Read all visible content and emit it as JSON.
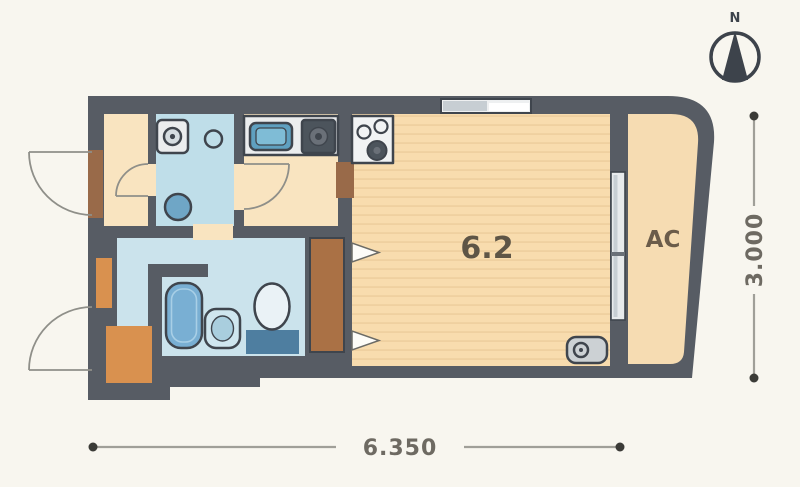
{
  "floor_plan": {
    "main_room_label": "6.2",
    "balcony_label": "AC",
    "compass_label": "N",
    "dimension_width_label": "6.350",
    "dimension_height_label": "3.000",
    "colors": {
      "background": "#f8f6ef",
      "wall": "#575c64",
      "floor_hall": "#f9e4c0",
      "floor_main": "#f8dcae",
      "floor_main_stripe": "#efd0a0",
      "floor_balcony": "#f6dcb2",
      "wet_room": "#bfdee9",
      "bathroom": "#cbe3ec",
      "fixture_blue": "#79afd3",
      "accent_orange": "#d9914f",
      "door_brown": "#996a49",
      "closet_brown": "#aa7145",
      "outline_dark": "#3f454d",
      "glass_gray": "#c7ced3",
      "dim_line": "#a09f98",
      "dim_text": "#6e6a62",
      "label_text": "#5e5546"
    }
  }
}
